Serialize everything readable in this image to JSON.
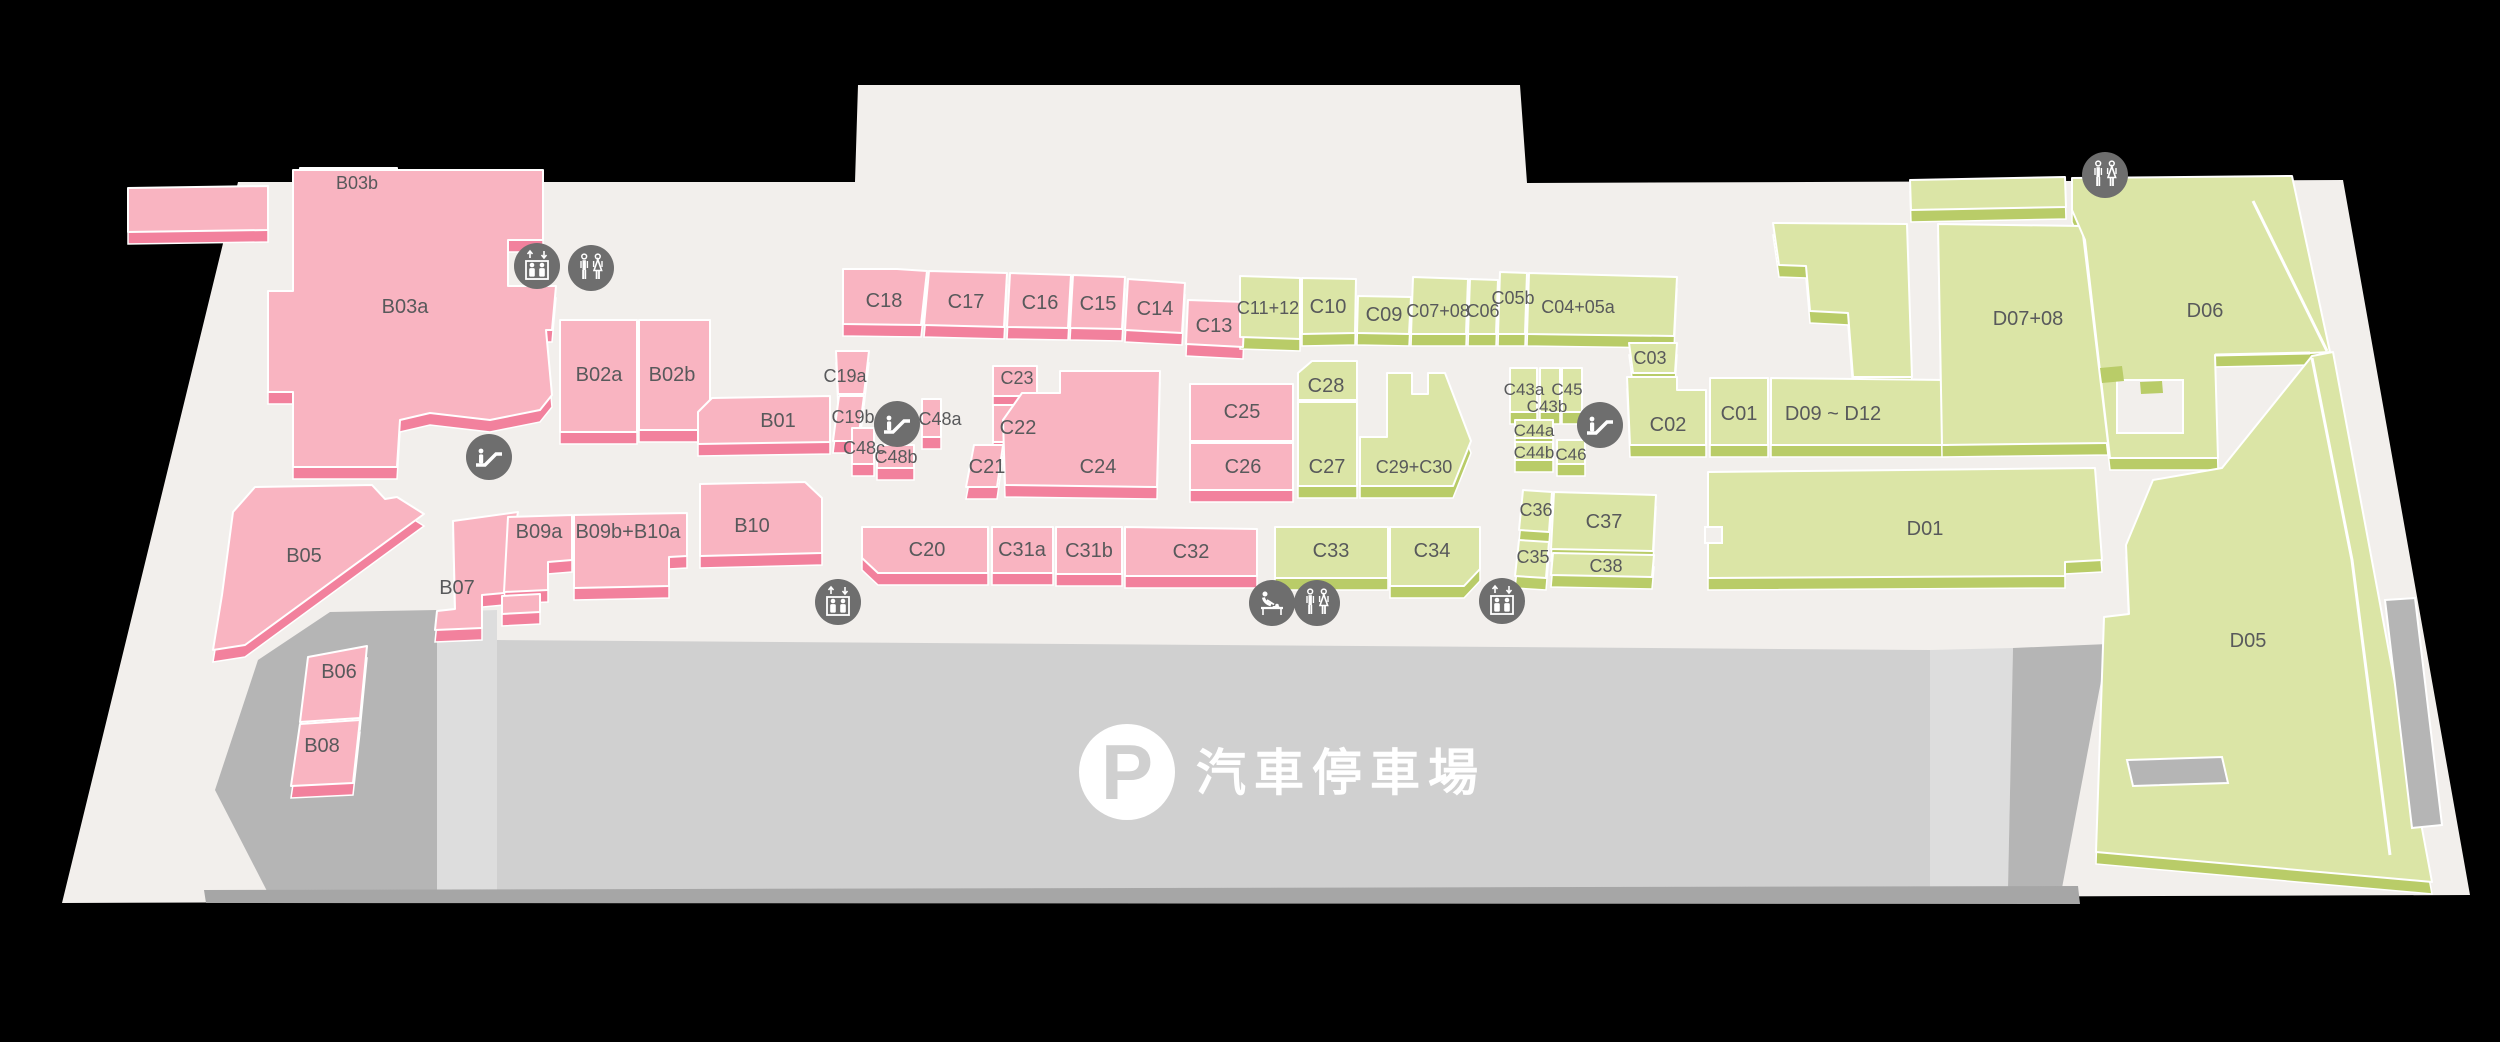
{
  "map_title": "mall-level-floor-plan",
  "colors": {
    "background": "#000000",
    "floor": "#f2efec",
    "pink_face": "#f9b4c1",
    "pink_side": "#f2819d",
    "green_face": "#dbe5a6",
    "green_side": "#b9cc68",
    "parking_main": "#d0d0d0",
    "parking_mid": "#dddddd",
    "parking_dark": "#b5b5b5",
    "parking_shadow": "#a6a6a6",
    "icon_bg": "#6e6e6e",
    "icon_glyph": "#ffffff",
    "label": "#58595b",
    "outline": "#ffffff",
    "parking_text": "#ffffff"
  },
  "floor_outline": "238,182 855,182 858,85 1520,85 1527,183 2343,180 2470,895 62,903",
  "parking": {
    "label": "汽車停車場",
    "p_glyph": "P",
    "zones": [
      {
        "name": "parking-left",
        "points": "330,612 437,610 437,890 268,893 215,790 258,660",
        "color": "parking_dark"
      },
      {
        "name": "parking-band",
        "points": "437,612 497,610 497,890 437,890",
        "color": "parking_mid"
      },
      {
        "name": "parking-main",
        "points": "497,640 1930,650 1930,888 497,892",
        "color": "parking_main"
      },
      {
        "name": "parking-light-right",
        "points": "1930,650 2013,648 2008,888 1930,888",
        "color": "parking_mid"
      },
      {
        "name": "parking-ramp",
        "points": "2013,648 2108,644 2062,888 2008,888",
        "color": "parking_dark"
      },
      {
        "name": "parking-shadow",
        "points": "204,890 2078,886 2080,904 206,903",
        "color": "parking_shadow"
      }
    ]
  },
  "units": [
    {
      "label": "B03b",
      "color": "pink",
      "points": "300,168 397,168 395,196 298,196",
      "lx": 357,
      "ly": 182,
      "fs": 18
    },
    {
      "label": "",
      "color": "pink",
      "points": "128,188 268,186 268,230 128,232",
      "lx": 0,
      "ly": 0
    },
    {
      "label": "B03a",
      "color": "pink",
      "points": "293,170 543,170 543,240 508,240 508,286 556,286 552,330 546,330 552,395 540,410 490,420 430,413 400,420 397,467 293,467 293,392 268,392 268,291 293,291",
      "lx": 405,
      "ly": 306
    },
    {
      "label": "B02a",
      "color": "pink",
      "points": "560,320 637,320 637,432 560,432",
      "lx": 599,
      "ly": 374
    },
    {
      "label": "B02b",
      "color": "pink",
      "points": "639,320 710,320 710,430 639,430",
      "lx": 672,
      "ly": 374
    },
    {
      "label": "B05",
      "color": "pink",
      "points": "255,487 372,485 385,499 397,497 424,514 245,645 213,650 222,595 233,512",
      "lx": 304,
      "ly": 555
    },
    {
      "label": "B06",
      "color": "pink",
      "points": "308,657 367,646 360,718 300,722",
      "lx": 339,
      "ly": 671
    },
    {
      "label": "B08",
      "color": "pink",
      "points": "300,724 360,720 353,783 291,786",
      "lx": 322,
      "ly": 745
    },
    {
      "label": "B07",
      "color": "pink",
      "points": "453,521 518,512 504,593 482,595 482,628 435,630 437,611 455,609",
      "lx": 457,
      "ly": 587
    },
    {
      "label": "",
      "color": "pink",
      "points": "502,596 540,594 540,612 502,614",
      "lx": 0,
      "ly": 0
    },
    {
      "label": "B09a",
      "color": "pink",
      "points": "508,517 572,515 572,560 548,562 548,590 504,592",
      "lx": 539,
      "ly": 531
    },
    {
      "label": "B09b+B10a",
      "color": "pink",
      "points": "574,515 687,513 687,556 669,557 669,586 574,588",
      "lx": 628,
      "ly": 531
    },
    {
      "label": "B10",
      "color": "pink",
      "points": "700,484 805,482 822,498 822,553 700,556",
      "lx": 752,
      "ly": 525
    },
    {
      "label": "B01",
      "color": "pink",
      "points": "698,412 712,398 830,396 830,442 698,444",
      "lx": 778,
      "ly": 420
    },
    {
      "label": "C19a",
      "color": "pink",
      "points": "836,351 869,351 864,394 838,394",
      "lx": 845,
      "ly": 375,
      "fs": 18
    },
    {
      "label": "C19b",
      "color": "pink",
      "points": "839,396 864,396 858,441 833,441",
      "lx": 853,
      "ly": 416,
      "fs": 18
    },
    {
      "label": "C48c",
      "color": "pink",
      "points": "852,428 874,428 874,464 852,464",
      "lx": 864,
      "ly": 447,
      "fs": 18
    },
    {
      "label": "C48b",
      "color": "pink",
      "points": "877,445 914,445 914,468 877,468",
      "lx": 896,
      "ly": 456,
      "fs": 18
    },
    {
      "label": "C48a",
      "color": "pink",
      "points": "922,399 941,399 941,437 922,437",
      "lx": 940,
      "ly": 418,
      "fs": 18
    },
    {
      "label": "C18",
      "color": "pink",
      "points": "843,269 897,269 927,271 921,325 843,324",
      "lx": 884,
      "ly": 300
    },
    {
      "label": "C17",
      "color": "pink",
      "points": "929,271 1007,273 1004,327 924,325",
      "lx": 966,
      "ly": 301
    },
    {
      "label": "C16",
      "color": "pink",
      "points": "1010,273 1071,275 1068,328 1007,327",
      "lx": 1040,
      "ly": 302
    },
    {
      "label": "C15",
      "color": "pink",
      "points": "1073,275 1125,277 1122,329 1070,328",
      "lx": 1098,
      "ly": 303
    },
    {
      "label": "C14",
      "color": "pink",
      "points": "1128,279 1185,283 1182,333 1125,330",
      "lx": 1155,
      "ly": 308
    },
    {
      "label": "C13",
      "color": "pink",
      "points": "1188,300 1245,302 1243,347 1186,344",
      "lx": 1214,
      "ly": 325
    },
    {
      "label": "C23",
      "color": "pink",
      "points": "993,366 1037,366 1037,396 993,396",
      "lx": 1017,
      "ly": 377,
      "fs": 18
    },
    {
      "label": "C22",
      "color": "pink",
      "points": "993,405 1048,405 1048,442 993,442",
      "lx": 1018,
      "ly": 427
    },
    {
      "label": "C21",
      "color": "pink",
      "points": "974,445 1003,445 997,487 966,487",
      "lx": 987,
      "ly": 466
    },
    {
      "label": "C24",
      "color": "pink",
      "points": "1005,485 1003,420 1022,393 1060,393 1060,371 1160,371 1157,487",
      "lx": 1098,
      "ly": 466
    },
    {
      "label": "C25",
      "color": "pink",
      "points": "1190,384 1293,384 1293,441 1190,441",
      "lx": 1242,
      "ly": 411
    },
    {
      "label": "C26",
      "color": "pink",
      "points": "1190,443 1293,443 1293,490 1190,490",
      "lx": 1243,
      "ly": 466
    },
    {
      "label": "C20",
      "color": "pink",
      "points": "862,527 988,527 988,573 878,573 862,558",
      "lx": 927,
      "ly": 549
    },
    {
      "label": "C31a",
      "color": "pink",
      "points": "992,527 1053,527 1053,573 992,573",
      "lx": 1022,
      "ly": 549
    },
    {
      "label": "C31b",
      "color": "pink",
      "points": "1056,527 1122,527 1122,574 1056,574",
      "lx": 1089,
      "ly": 550
    },
    {
      "label": "C32",
      "color": "pink",
      "points": "1125,527 1257,529 1257,576 1125,576",
      "lx": 1191,
      "ly": 551
    },
    {
      "label": "C11+12",
      "color": "green",
      "points": "1240,276 1300,278 1300,339 1240,337",
      "lx": 1268,
      "ly": 307,
      "fs": 18
    },
    {
      "label": "C10",
      "color": "green",
      "points": "1302,278 1356,279 1355,333 1302,334",
      "lx": 1328,
      "ly": 306
    },
    {
      "label": "C09",
      "color": "green",
      "points": "1358,296 1411,297 1409,334 1357,333",
      "lx": 1384,
      "ly": 314
    },
    {
      "label": "C07+08",
      "color": "green",
      "points": "1413,277 1468,279 1466,334 1411,334",
      "lx": 1438,
      "ly": 310,
      "fs": 18
    },
    {
      "label": "C06",
      "color": "green",
      "points": "1470,279 1498,280 1496,334 1468,334",
      "lx": 1483,
      "ly": 310,
      "fs": 18
    },
    {
      "label": "C05b",
      "color": "green",
      "points": "1500,272 1527,273 1525,334 1498,334",
      "lx": 1513,
      "ly": 297,
      "fs": 18
    },
    {
      "label": "C04+05a",
      "color": "green",
      "points": "1529,273 1677,277 1674,336 1527,334",
      "lx": 1578,
      "ly": 306,
      "fs": 18
    },
    {
      "label": "C28",
      "color": "green",
      "points": "1312,361 1357,361 1357,400 1298,400 1298,373",
      "lx": 1326,
      "ly": 385
    },
    {
      "label": "C27",
      "color": "green",
      "points": "1298,402 1357,402 1357,486 1298,486",
      "lx": 1327,
      "ly": 466
    },
    {
      "label": "C29+C30",
      "color": "green",
      "points": "1387,373 1412,373 1412,394 1428,394 1428,373 1445,373 1471,441 1453,486 1360,486 1360,437 1387,437",
      "lx": 1414,
      "ly": 466,
      "fs": 18
    },
    {
      "label": "C33",
      "color": "green",
      "points": "1275,527 1388,527 1388,578 1275,578",
      "lx": 1331,
      "ly": 550
    },
    {
      "label": "C34",
      "color": "green",
      "points": "1390,527 1480,527 1480,569 1464,586 1390,586",
      "lx": 1432,
      "ly": 550
    },
    {
      "label": "C36",
      "color": "green",
      "points": "1523,490 1552,492 1549,532 1519,530",
      "lx": 1536,
      "ly": 509,
      "fs": 18
    },
    {
      "label": "C35",
      "color": "green",
      "points": "1519,540 1549,542 1546,578 1515,576",
      "lx": 1533,
      "ly": 556,
      "fs": 18
    },
    {
      "label": "C37",
      "color": "green",
      "points": "1554,492 1656,495 1653,551 1551,549",
      "lx": 1604,
      "ly": 521
    },
    {
      "label": "C38",
      "color": "green",
      "points": "1553,553 1654,555 1652,577 1551,575",
      "lx": 1606,
      "ly": 565,
      "fs": 18
    },
    {
      "label": "C43a",
      "color": "green",
      "points": "1510,368 1537,368 1537,412 1510,412",
      "lx": 1524,
      "ly": 388,
      "fs": 17
    },
    {
      "label": "C43b",
      "color": "green",
      "points": "1540,368 1560,368 1560,412 1540,412",
      "lx": 1547,
      "ly": 405,
      "fs": 17
    },
    {
      "label": "C45",
      "color": "green",
      "points": "1562,368 1582,368 1582,412 1562,412",
      "lx": 1567,
      "ly": 388,
      "fs": 17
    },
    {
      "label": "C44a",
      "color": "green",
      "points": "1515,420 1553,420 1553,438 1515,438",
      "lx": 1534,
      "ly": 429,
      "fs": 17
    },
    {
      "label": "C44b",
      "color": "green",
      "points": "1515,442 1553,442 1553,460 1515,460",
      "lx": 1534,
      "ly": 451,
      "fs": 17
    },
    {
      "label": "C46",
      "color": "green",
      "points": "1557,440 1585,440 1585,464 1557,464",
      "lx": 1571,
      "ly": 453,
      "fs": 17
    },
    {
      "label": "C03",
      "color": "green",
      "points": "1629,343 1677,343 1675,373 1633,373",
      "lx": 1650,
      "ly": 357,
      "fs": 18
    },
    {
      "label": "C02",
      "color": "green",
      "points": "1627,377 1677,377 1677,390 1706,390 1706,445 1630,445",
      "lx": 1668,
      "ly": 424
    },
    {
      "label": "C01",
      "color": "green",
      "points": "1710,378 1768,378 1768,445 1710,445",
      "lx": 1739,
      "ly": 413
    },
    {
      "label": "D09 ~ D12",
      "color": "green",
      "points": "1771,378 1945,380 1948,445 1771,445",
      "lx": 1833,
      "ly": 413
    },
    {
      "label": "",
      "color": "green",
      "points": "1773,223 1907,224 1912,377 1853,377 1848,313 1810,311 1806,266 1779,265",
      "lx": 0,
      "ly": 0
    },
    {
      "label": "",
      "color": "green",
      "points": "1910,180 2065,177 2066,207 1911,210",
      "lx": 0,
      "ly": 0
    },
    {
      "label": "D07+08",
      "color": "green",
      "points": "1938,224 2082,226 2108,443 1942,445",
      "lx": 2028,
      "ly": 318
    },
    {
      "label": "D06",
      "color": "green",
      "points": "2072,178 2292,176 2330,352 2310,353 2215,355 2218,458 2110,458 2085,240 2072,210",
      "lx": 2205,
      "ly": 310
    },
    {
      "label": "D05",
      "color": "green",
      "points": "2096,852 2104,617 2129,614 2126,545 2153,480 2222,468 2312,356 2333,352 2432,882",
      "lx": 2248,
      "ly": 640
    },
    {
      "label": "D01",
      "color": "green",
      "points": "1708,472 2095,468 2102,560 2065,562 2065,576 1708,578",
      "lx": 1925,
      "ly": 528
    }
  ],
  "overlays": [
    {
      "name": "d06-cutout",
      "points": "2117,380 2183,380 2183,433 2117,433",
      "color": "floor",
      "stroke": true
    },
    {
      "name": "d06-step-1",
      "points": "2100,368 2122,366 2124,381 2102,383",
      "color": "green_side"
    },
    {
      "name": "d06-step-2",
      "points": "2140,382 2162,381 2163,393 2141,394",
      "color": "green_side"
    },
    {
      "name": "d01-notch",
      "points": "1705,527 1722,527 1722,543 1705,543",
      "color": "floor",
      "stroke": true
    },
    {
      "name": "d05-slot",
      "points": "2127,760 2222,757 2228,783 2133,786",
      "color": "parking_dark",
      "stroke": true
    },
    {
      "name": "d05-right-ramp",
      "points": "2385,600 2415,598 2442,825 2412,828",
      "color": "parking_dark",
      "stroke": true
    }
  ],
  "divider_lines": [
    "2253,201 2327,351",
    "2215,355 2310,353",
    "2312,358 2352,560 2390,855"
  ],
  "icons": [
    {
      "type": "elevator",
      "x": 537,
      "y": 266
    },
    {
      "type": "toilets",
      "x": 591,
      "y": 268
    },
    {
      "type": "escalator",
      "x": 489,
      "y": 457
    },
    {
      "type": "escalator",
      "x": 897,
      "y": 424
    },
    {
      "type": "escalator",
      "x": 1600,
      "y": 425
    },
    {
      "type": "elevator",
      "x": 838,
      "y": 602
    },
    {
      "type": "baby-change",
      "x": 1272,
      "y": 603
    },
    {
      "type": "toilets",
      "x": 1317,
      "y": 603
    },
    {
      "type": "elevator",
      "x": 1502,
      "y": 601
    },
    {
      "type": "toilets",
      "x": 2105,
      "y": 175
    }
  ]
}
